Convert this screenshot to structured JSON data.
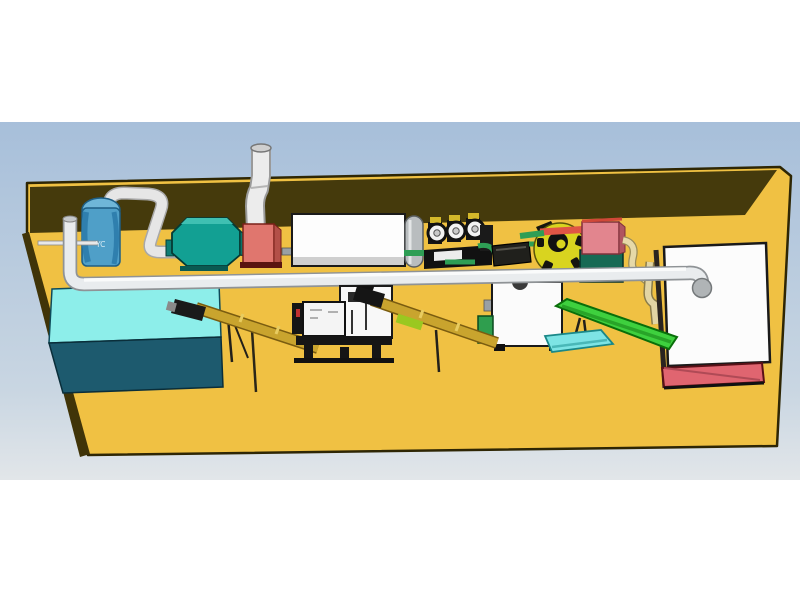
{
  "scene": {
    "type": "3d-cad-rendering",
    "description": "Industrial pellet production line equipment layout on a yellow platform with back wall, viewed in perspective against a blue gradient sky",
    "tank_label": "YC"
  },
  "equipment": [
    {
      "name": "cyclone-tank",
      "label": "YC",
      "color": "#4f9fc8"
    },
    {
      "name": "blower-housing",
      "color": "#12a093"
    },
    {
      "name": "furnace-box",
      "color": "#e0766e"
    },
    {
      "name": "chimney-pipe",
      "color": "#ececec"
    },
    {
      "name": "dryer-box",
      "color": "#fdfdfd"
    },
    {
      "name": "drum-cylinder",
      "color": "#b9bdbf"
    },
    {
      "name": "roller-mill",
      "color": "#111111"
    },
    {
      "name": "hopper-box",
      "color": "#20201c"
    },
    {
      "name": "centrifugal-fan",
      "color": "#d9d41f"
    },
    {
      "name": "control-cabinet",
      "color": "#e2858e"
    },
    {
      "name": "water-tank",
      "color": "#8deeea"
    },
    {
      "name": "screw-conveyor-1",
      "color": "#c9a42e"
    },
    {
      "name": "pellet-mill",
      "color": "#151515"
    },
    {
      "name": "screw-conveyor-2",
      "color": "#c9a42e"
    },
    {
      "name": "discharge-box",
      "color": "#fbfbfb"
    },
    {
      "name": "belt-conveyor",
      "color": "#3ed03e"
    },
    {
      "name": "chute",
      "color": "#7de4e4"
    },
    {
      "name": "storage-bin",
      "color": "#fcfcfc"
    },
    {
      "name": "storage-bin-base",
      "color": "#e06570"
    },
    {
      "name": "main-pipe",
      "color": "#e9ecee"
    }
  ],
  "colors": {
    "sky_top": "#a7bfda",
    "sky_bottom": "#e2e6e9",
    "platform_yellow": "#f0c143",
    "wall_brown": "#453a0c",
    "edge_dark": "#403408",
    "tank_blue": "#4f9fc8",
    "blower_teal": "#12a093",
    "box_pink": "#e0766e",
    "fan_yellow": "#d9d41f",
    "cabinet_pink": "#e2858e",
    "cabinet_base_teal": "#176a54",
    "water_tank_cyan": "#8deeea",
    "water_tank_dark": "#1d5a6e",
    "screw_yellow": "#c9a42e",
    "conveyor_green": "#3ed03e",
    "bin_base_pink": "#e06570",
    "pipe_white": "#e9ecee",
    "pipe_green": "#2e9e55"
  }
}
